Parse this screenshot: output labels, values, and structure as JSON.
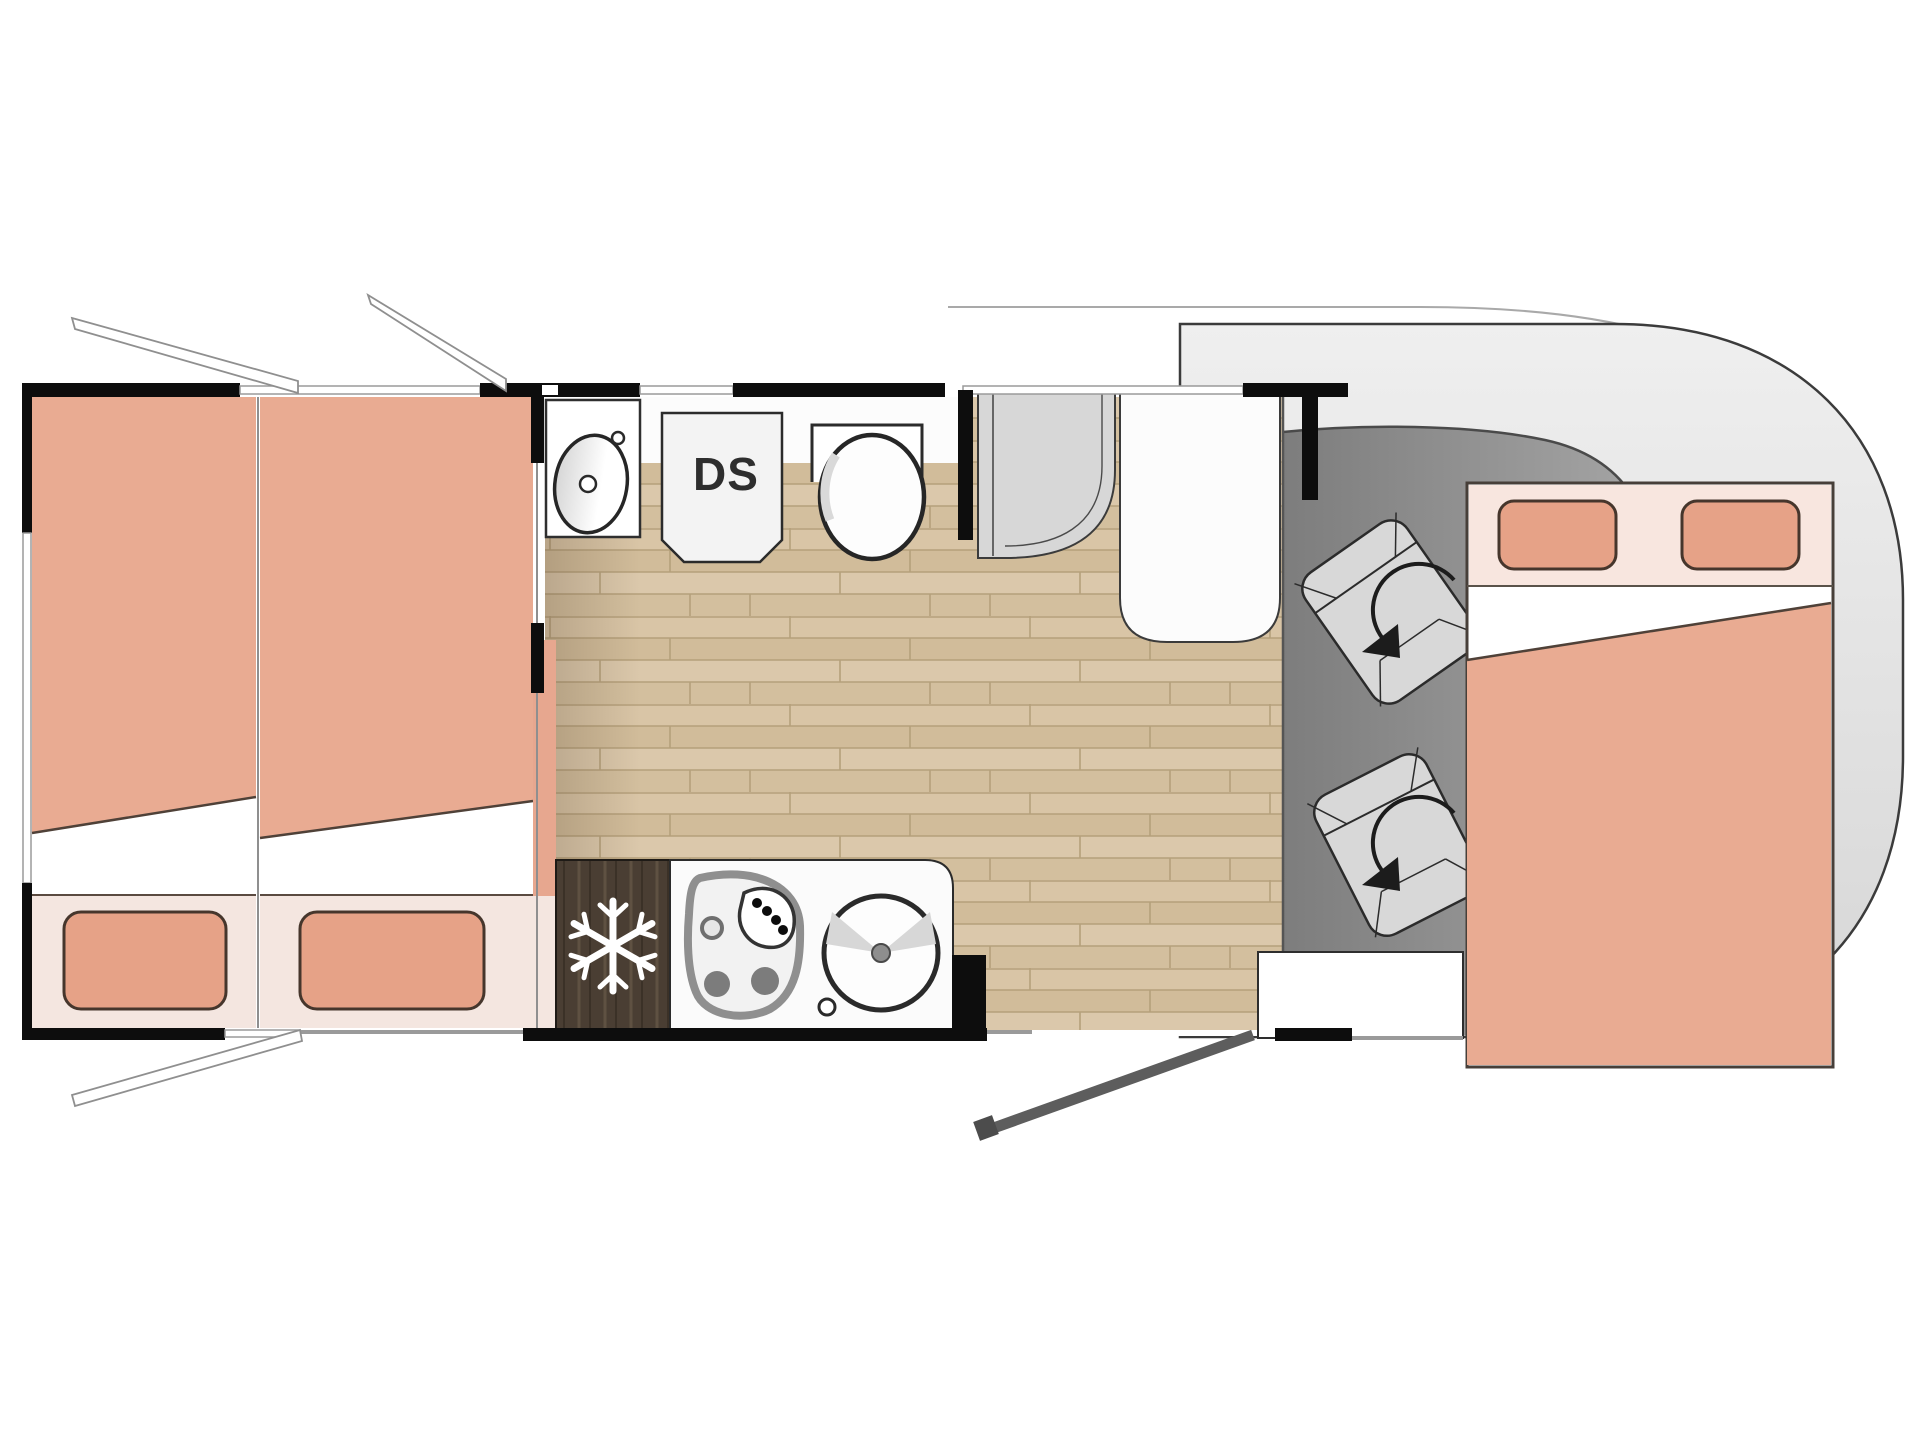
{
  "title": "Motorhome floor plan",
  "labels": {
    "ds_unit": "DS"
  },
  "icons": {
    "snowflake": "snowflake-icon (fridge/freezer)",
    "swivel_arrow": "rotation-arrow-icon (swivel cab seat)",
    "open_window_flap": "open-window-flap lines",
    "door_swing": "entry-door swing line"
  },
  "colors": {
    "bed_duvet": "#e9ab92",
    "bed_pillow": "#e6a287",
    "bed_footer": "#f4e6e0",
    "bed_header_band": "#f8e6df",
    "wood_floor": "#d6c2a2",
    "fridge_dark_wood": "#4a3e33",
    "cab_floor_gray": "#8c8c8c",
    "body_shell_gray": "#e7e7e7",
    "shower_gray": "#d7d7d7",
    "wall_black": "#0d0d0d",
    "outline_dark": "#3b3b3b"
  },
  "rooms": [
    "rear twin beds",
    "bathroom with washbasin, DS shower unit and toilet",
    "kitchen with fridge, hob and round sink",
    "wardrobe and shower cubicle",
    "cab with two swivel seats",
    "drop-down double bed over cab",
    "entry door with step"
  ]
}
